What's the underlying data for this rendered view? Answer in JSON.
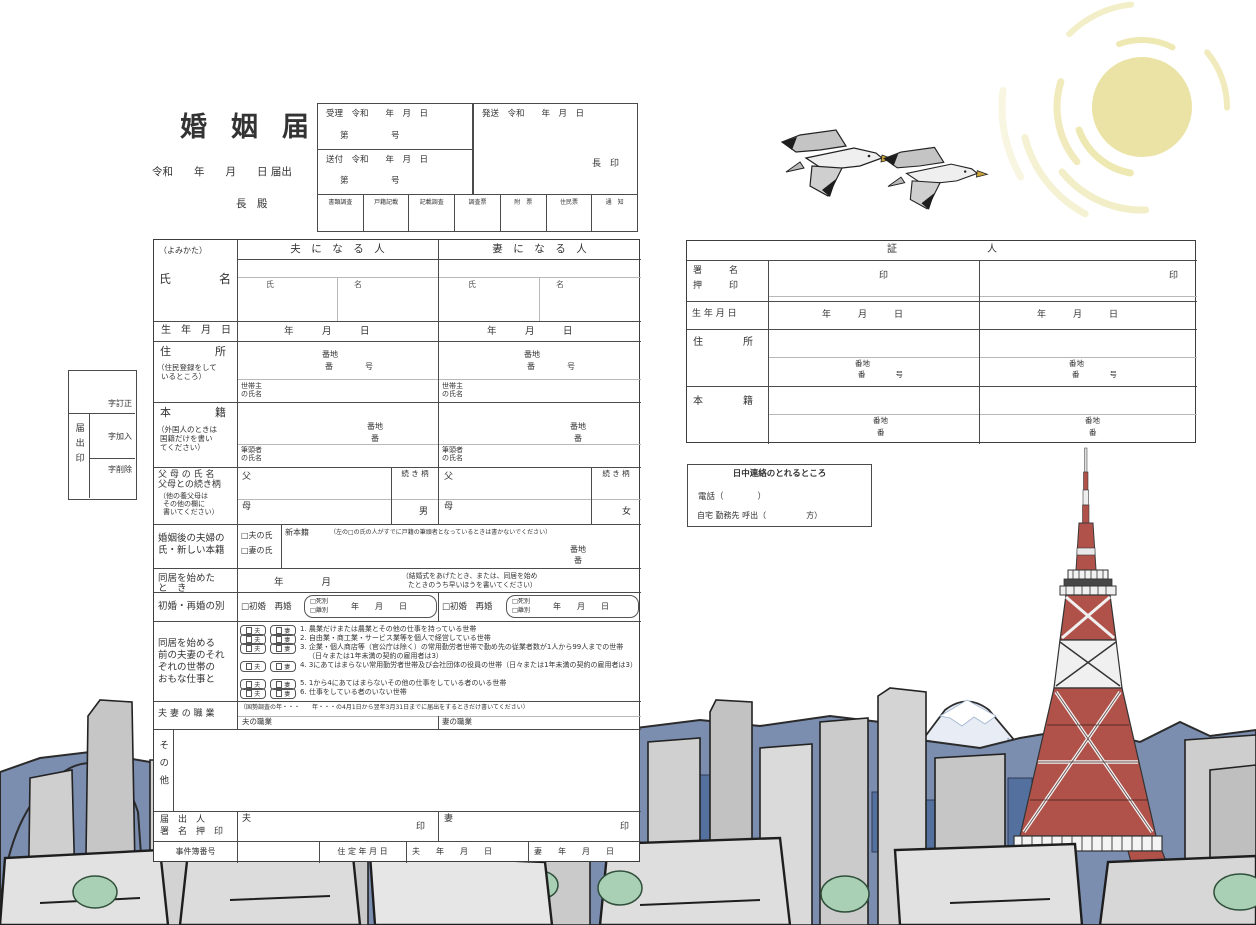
{
  "header": {
    "title": "婚姻届",
    "date_line": "令和　　年　　月　　日 届出",
    "mayor": "長　殿",
    "juri": "受理　令和　　年　月　日",
    "sofu": "送付　令和　　年　月　日",
    "hasso": "発送　令和　　年　月　日",
    "no_line": "第　　　　　号",
    "mayor_seal": "長　印",
    "stamps": [
      "書類調査",
      "戸籍記載",
      "記載調査",
      "調査票",
      "附　票",
      "住民票",
      "通　知"
    ]
  },
  "margin": {
    "lines": [
      "字訂正",
      "字加入",
      "字削除"
    ],
    "seal": "届出印"
  },
  "common": {
    "year": "年",
    "month": "月",
    "day": "日",
    "ymd": "年　　月　　日",
    "ymd_wide": "年　　　月　　　日",
    "banchi": "番地",
    "ban": "番",
    "ban_go": "番　　　　号",
    "seal": "印",
    "husband": "夫",
    "wife": "妻"
  },
  "main": {
    "husband_col": "夫　に　な　る　人",
    "wife_col": "妻　に　な　る　人",
    "yomikata": "（よみかた）",
    "name_label": "氏　　　　名",
    "sei": "氏",
    "mei": "名",
    "birth_label": "生　年　月　日",
    "addr_label": "住　　　　所",
    "addr_note1": "（住民登録をして",
    "addr_note2": "いるところ）",
    "householder1": "世帯主",
    "householder2": "の氏名",
    "honseki_label": "本　　　　籍",
    "honseki_note1": "（外国人のときは",
    "honseki_note2": "国籍だけを書い",
    "honseki_note3": "てください）",
    "hittousha1": "筆頭者",
    "hittousha2": "の氏名",
    "parents_label1": "父 母 の 氏 名",
    "parents_label2": "父母との続き柄",
    "parents_note1": "（他の養父母は",
    "parents_note2": "その他の欄に",
    "parents_note3": "書いてください）",
    "father": "父",
    "mother": "母",
    "tsuzuki": "続 き 柄",
    "male": "男",
    "female": "女",
    "surname_label1": "婚姻後の夫婦の",
    "surname_label2": "氏・新しい本籍",
    "opt_husband": "□夫の氏",
    "opt_wife": "□妻の氏",
    "new_honseki": "新本籍",
    "surname_note": "（左の□の氏の人がすでに戸籍の筆頭者となっているときは書かないでください）",
    "cohabit_label1": "同居を始めた",
    "cohabit_label2": "と　き",
    "cohabit_ym": "年　　　　月",
    "cohabit_note1": "（結婚式をあげたとき、または、同居を始め",
    "cohabit_note2": "たときのうち早いほうを書いてください）",
    "marriage_label": "初婚・再婚の別",
    "first_re": "□初婚　再婚",
    "death": "□死別",
    "divorce": "□離別",
    "work_label1": "同居を始める",
    "work_label2": "前の夫妻のそれ",
    "work_label3": "ぞれの世帯の",
    "work_label4": "おもな仕事と",
    "work_items": [
      "1. 農業だけまたは農業とその他の仕事を持っている世帯",
      "2. 自由業・商工業・サービス業等を個人で経営している世帯",
      "3. 企業・個人商店等（官公庁は除く）の常用勤労者世帯で勤め先の従業者数が1人から99人までの世帯（日々または1年未満の契約の雇用者は3）",
      "4. 3にあてはまらない常用勤労者世帯及び会社団体の役員の世帯（日々または1年未満の契約の雇用者は3）",
      "5. 1から4にあてはまらないその他の仕事をしている者のいる世帯",
      "6. 仕事をしている者のいない世帯"
    ],
    "occ_label": "夫 妻 の 職 業",
    "occ_note": "（国勢調査の年・・・　　年・・・の4月1日から翌年3月31日までに届出をするときだけ書いてください）",
    "occ_husband": "夫の職業",
    "occ_wife": "妻の職業",
    "other_label": "その他",
    "submit_label1": "届　出　人",
    "submit_label2": "署　名　押　印",
    "case_label": "事件簿番号",
    "jutei": "住 定 年 月 日",
    "case_h": "夫　　年　　月　　日",
    "case_w": "妻　　年　　月　　日"
  },
  "witness": {
    "header": "証　　　　　　　　　人",
    "sign1": "署　　　名",
    "sign2": "押　　　印",
    "birth": "生 年 月 日",
    "addr": "住　　　　所",
    "honseki": "本　　　　籍"
  },
  "contact": {
    "title": "日中連絡のとれるところ",
    "tel": "電話（　　　　）",
    "line2": "自宅 勤務先 呼出（　　　　　方）"
  },
  "illustration": {
    "sun_color": "#ebe3a6",
    "mountain_color": "#7b8eb0",
    "distant_building_color": "#54709f",
    "building_gray": "#cfcfcf",
    "tower_red": "#b0524a",
    "tree_green": "#a9cfb4",
    "elements": [
      "sun",
      "seagulls",
      "mount-fuji",
      "mountain-range",
      "city-skyline",
      "tokyo-tower",
      "trees"
    ]
  }
}
